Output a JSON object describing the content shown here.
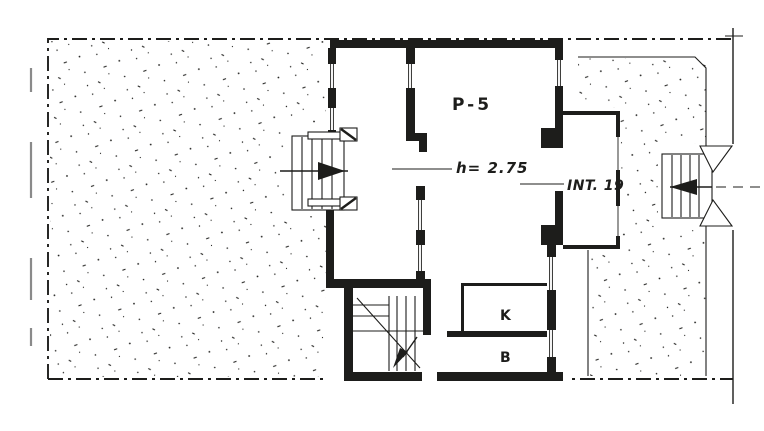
{
  "plan": {
    "labels": {
      "floor": "P-5",
      "height_note": "h= 2.75",
      "unit": "INT. 19",
      "kitchen": "K",
      "bathroom": "B"
    },
    "colors": {
      "ink": "#1d1d1b",
      "paper": "#ffffff"
    }
  }
}
